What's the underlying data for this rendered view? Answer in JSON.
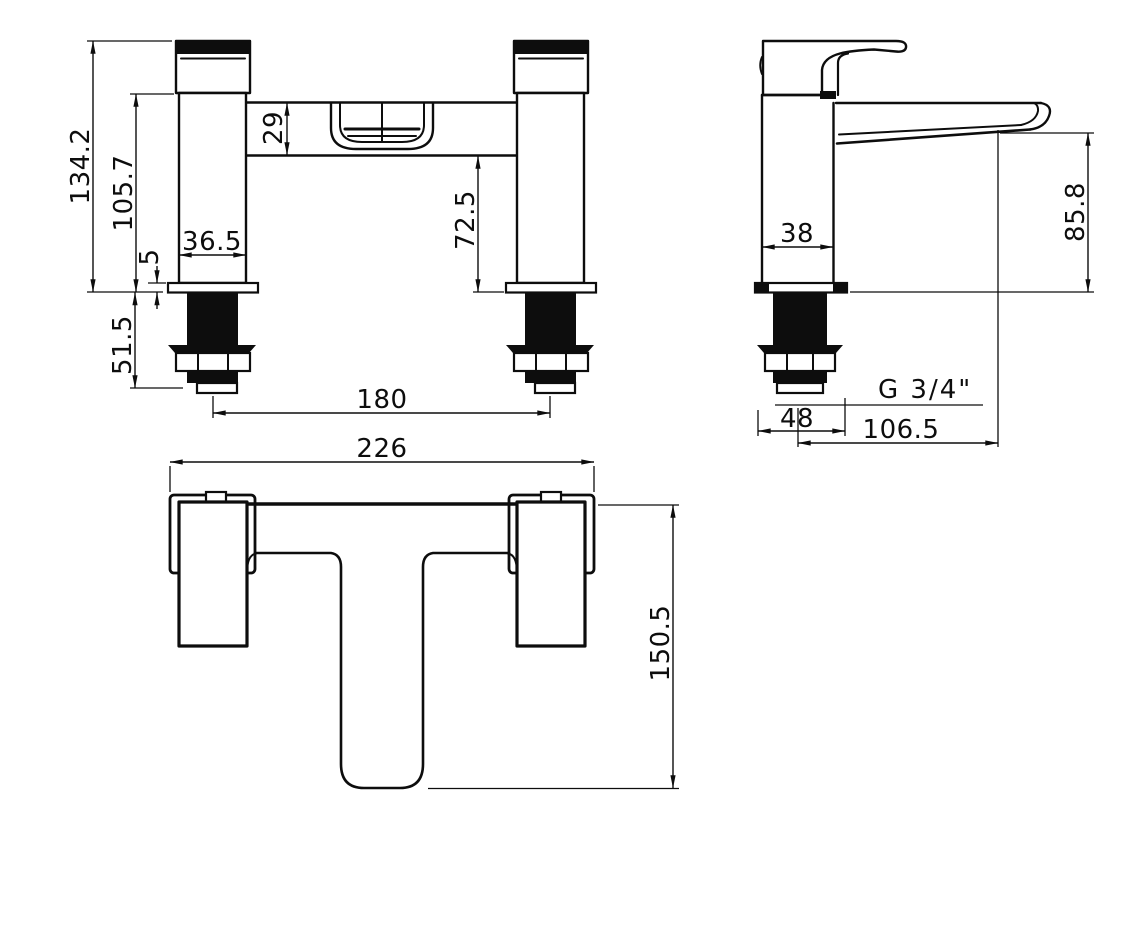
{
  "drawing": {
    "front": {
      "overall_height": "134.2",
      "height_to_body": "105.7",
      "body_section_height": "29",
      "deck_plate_thickness": "5",
      "pillar_width": "36.5",
      "deck_to_body_clearance": "72.5",
      "shank_length": "51.5",
      "tap_hole_centres": "180"
    },
    "side": {
      "body_depth": "38",
      "spout_outlet_height": "85.8",
      "thread_size": "G 3/4\"",
      "base_plate_depth": "48",
      "spout_reach": "106.5"
    },
    "plan": {
      "overall_width": "226",
      "overall_depth": "150.5"
    }
  }
}
